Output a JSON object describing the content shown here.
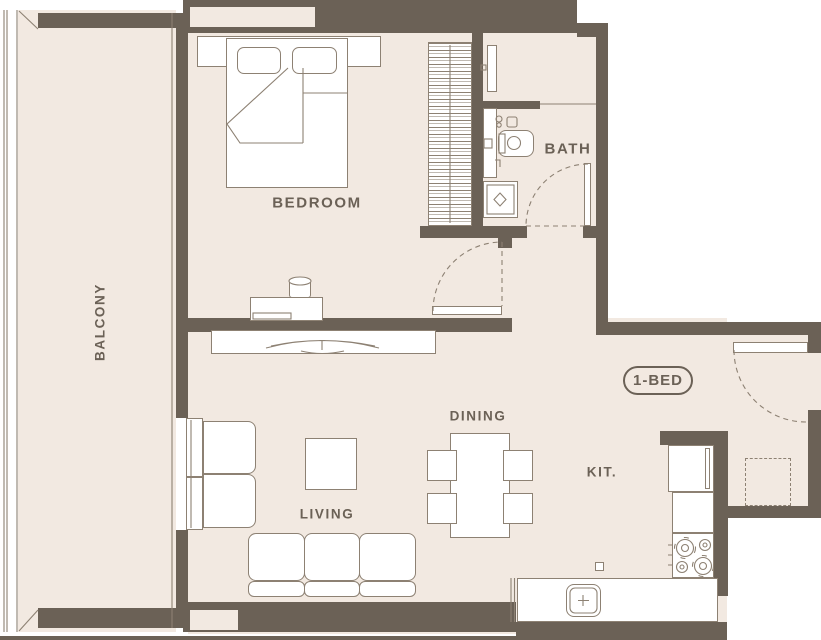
{
  "plan": {
    "unit_badge": "1-BED",
    "rooms": {
      "balcony": "BALCONY",
      "bedroom": "BEDROOM",
      "bath": "BATH",
      "living": "LIVING",
      "dining": "DINING",
      "kitchen": "KIT."
    },
    "colors": {
      "wall": "#6b6156",
      "floor": "#f2e9e1",
      "furniture": "#ffffff",
      "line": "#8d8173",
      "text": "#6b6156",
      "outside": "#ffffff"
    }
  }
}
